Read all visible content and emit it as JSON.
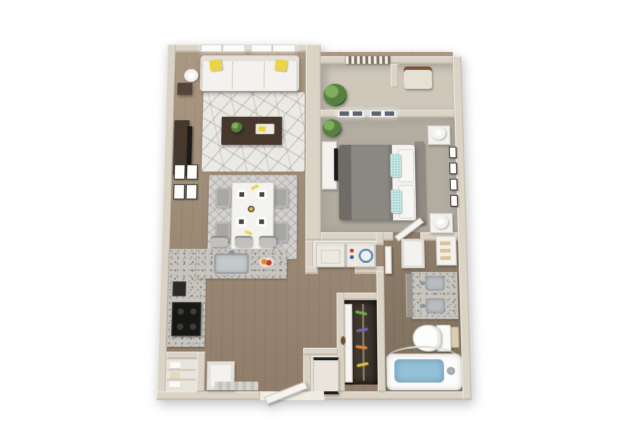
{
  "scene": {
    "kind": "3d-floorplan-render",
    "unit_layout": "one-bedroom-one-bath-apartment"
  },
  "palette": {
    "background": "#ffffff",
    "wall": "#dbd3c5",
    "wood": "#ab9983",
    "wood_dark": "#907e6b",
    "carpet": "#b3aca1",
    "balcony_floor": "#cfc8ba",
    "rug_living": "#ebe9e4",
    "rug_dining": "#d3d2d0",
    "granite": "#c8c5bf",
    "white_furn": "#f3f2ef",
    "dark_wood": "#46382c",
    "tv_black": "#1b1a19",
    "accent_yellow": "#e9d44a",
    "accent_teal": "#a9d6d6",
    "bed_gray": "#8b8781",
    "bed_gray_dark": "#6f6b66",
    "headboard": "#8f8a83",
    "plant_green": "#57803f",
    "water_blue": "#93c2d8",
    "window_pane": "#5a6570",
    "closet_dark": "#3f372e",
    "knob_red": "#c0392b",
    "knob_blue": "#2e5fa3"
  },
  "rooms": [
    {
      "name": "living-room"
    },
    {
      "name": "dining-area"
    },
    {
      "name": "kitchen"
    },
    {
      "name": "bedroom"
    },
    {
      "name": "balcony"
    },
    {
      "name": "bathroom"
    },
    {
      "name": "walk-in-closet"
    },
    {
      "name": "laundry-closet"
    },
    {
      "name": "entry"
    },
    {
      "name": "pantry-closet"
    }
  ],
  "furniture": [
    {
      "room": "living-room",
      "items": [
        "sofa-with-yellow-pillows",
        "coffee-table",
        "geometric-rug",
        "tv-console",
        "flat-tv",
        "floor-lamp",
        "side-table",
        "wall-frames-x4",
        "double-window"
      ]
    },
    {
      "room": "dining-area",
      "items": [
        "dining-table",
        "chairs-x4",
        "place-settings-x4",
        "diamond-rug"
      ]
    },
    {
      "room": "kitchen",
      "items": [
        "l-shaped-granite-counter",
        "sink",
        "bar-stools-x3",
        "cooktop",
        "wall-oven",
        "fruit-bowl",
        "refrigerator",
        "base-cabinet"
      ]
    },
    {
      "room": "bedroom",
      "items": [
        "bed-gray-duvet",
        "teal-pillows",
        "headboard",
        "nightstands-x2",
        "lamps-x2",
        "dresser-with-tv",
        "plant",
        "wall-frames-x4",
        "grid-windows-x2"
      ]
    },
    {
      "room": "balcony",
      "items": [
        "railing",
        "plant",
        "patio-chair"
      ]
    },
    {
      "room": "bathroom",
      "items": [
        "double-vanity-granite",
        "mirror-cabinet",
        "linen-shelf-with-towels",
        "toilet",
        "bathtub-with-water",
        "shower-curtain-rod"
      ]
    },
    {
      "room": "walk-in-closet",
      "items": [
        "colored-hangers",
        "closet-door"
      ]
    },
    {
      "room": "laundry-closet",
      "items": [
        "dryer",
        "washer"
      ]
    },
    {
      "room": "entry",
      "items": [
        "entry-door-open",
        "doormat"
      ]
    },
    {
      "room": "pantry-closet",
      "items": [
        "shelves-with-linens"
      ]
    }
  ],
  "counts": {
    "living_windows": 2,
    "bedroom_windows": 2,
    "dining_chairs": 4,
    "bar_stools": 3,
    "living_wall_frames": 4,
    "bedroom_wall_frames": 4,
    "laundry_units": 2
  }
}
